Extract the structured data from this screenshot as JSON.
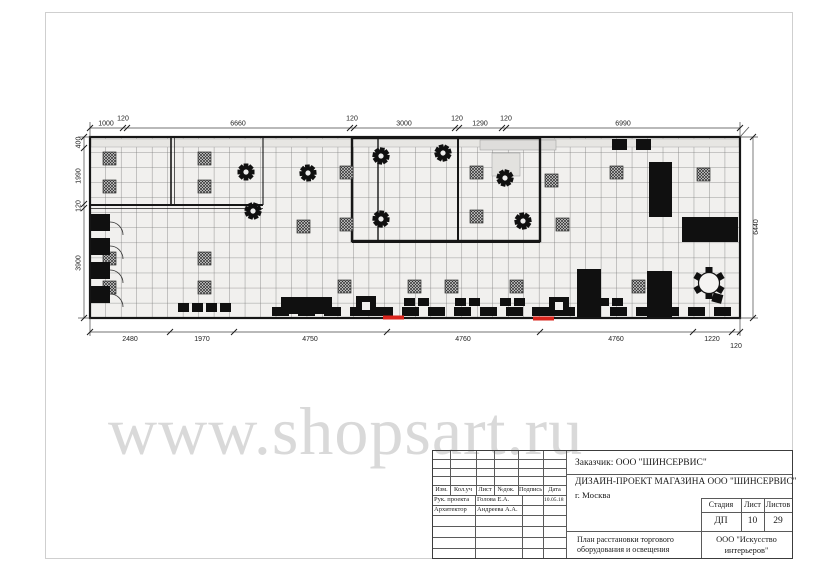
{
  "sheet": {
    "watermark": "www.shopsart.ru"
  },
  "plan": {
    "dim_top": [
      "1000",
      "120",
      "6660",
      "120",
      "3000",
      "120",
      "1290",
      "120",
      "6990"
    ],
    "dim_bottom": [
      "2480",
      "1970",
      "4750",
      "4760",
      "4760",
      "1220",
      "120"
    ],
    "dim_left": [
      "400",
      "1990",
      "120",
      "3900"
    ],
    "dim_right": [
      "6440"
    ]
  },
  "title_block": {
    "customer": "Заказчик:  ООО \"ШИНСЕРВИС\"",
    "project": "ДИЗАЙН-ПРОЕКТ МАГАЗИНА  ООО \"ШИНСЕРВИС\"",
    "city": "г. Москва",
    "columns": [
      "Изм.",
      "Кол.уч",
      "Лист",
      "№док.",
      "Подпись",
      "Дата"
    ],
    "rows": [
      {
        "role": "Рук. проекта",
        "name": "Голова Е.А.",
        "date": "10.05.18"
      },
      {
        "role": "Архитектор",
        "name": "Андреева А.А.",
        "date": ""
      }
    ],
    "stage_headers": [
      "Стадия",
      "Лист",
      "Листов"
    ],
    "stage_values": [
      "ДП",
      "10",
      "29"
    ],
    "sheet_title": "План расстановки торгового оборудования и освещения",
    "company": "ООО \"Искусство интерьеров\""
  },
  "colors": {
    "wall": "#161616",
    "entrance_red": "#da251d",
    "watermark_gray": "#d9d9d9"
  }
}
